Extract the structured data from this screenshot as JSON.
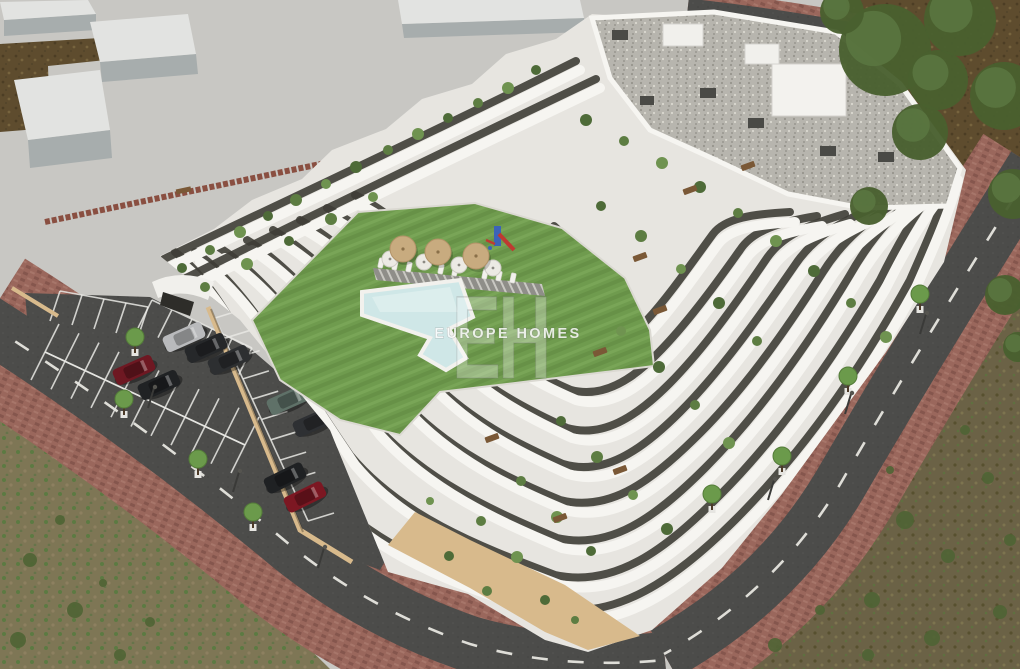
{
  "meta": {
    "image_type": "aerial architectural 3D render",
    "subject": "modern white terraced apartment complex with courtyard lawn, swimming pool, playground, parking lot and surrounding roads"
  },
  "watermark": {
    "monogram": "EH",
    "brand": "EUROPE HOMES"
  },
  "palette": {
    "concrete": "#c8c7c3",
    "building_white": "#e7e5e0",
    "parapet_white": "#f6f5f1",
    "glazing_dark": "#3e3d36",
    "roof_gravel": "#b7b5ae",
    "lawn_green": "#6f9b4e",
    "pool_water": "#cfe7e7",
    "asphalt": "#4c4c4a",
    "sidewalk_brick": "#9a675c",
    "dirt_brown": "#5e4c2e",
    "scrub_field": "#7e7655",
    "base_wall_tan": "#d8ba8c",
    "plant_greens": [
      "#4e6b38",
      "#5d7d42",
      "#6f9350"
    ],
    "playground_blue": "#3c63b8",
    "playground_red": "#bf3a31",
    "parasol_tan": "#c8ab7f",
    "wood_brown": "#7a5836"
  },
  "scene": {
    "massing_blocks": [
      {
        "top": "0,2 88,0 96,14 4,20",
        "side": "4,20 96,14 96,30 4,36"
      },
      {
        "top": "90,22 188,14 196,54 100,62",
        "side": "100,62 196,54 198,74 102,82"
      },
      {
        "top": "14,80 100,70 110,130 28,140",
        "side": "28,140 110,130 112,158 30,168"
      },
      {
        "top": "398,0 580,0 584,18 402,24",
        "side": "402,24 584,18 586,32 404,38"
      }
    ],
    "cars": [
      {
        "x": 184,
        "y": 337,
        "rot": -24,
        "color": "#b9babc",
        "name": "silver-car"
      },
      {
        "x": 206,
        "y": 348,
        "rot": -24,
        "color": "#26282a",
        "name": "black-car"
      },
      {
        "x": 229,
        "y": 360,
        "rot": -24,
        "color": "#2d2f31",
        "name": "dark-gray-car"
      },
      {
        "x": 134,
        "y": 370,
        "rot": -24,
        "color": "#6e1822",
        "name": "dark-red-car"
      },
      {
        "x": 159,
        "y": 385,
        "rot": -24,
        "color": "#202224",
        "name": "black-car"
      },
      {
        "x": 288,
        "y": 400,
        "rot": -24,
        "color": "#5f7168",
        "name": "green-suv"
      },
      {
        "x": 314,
        "y": 422,
        "rot": -24,
        "color": "#2e3033",
        "name": "dark-gray-car"
      },
      {
        "x": 285,
        "y": 478,
        "rot": -26,
        "color": "#1f2123",
        "name": "black-car"
      },
      {
        "x": 305,
        "y": 497,
        "rot": -26,
        "color": "#7c1722",
        "name": "dark-red-car"
      }
    ],
    "parking_rows": [
      {
        "x1": 60,
        "y1": 291,
        "dx": 22,
        "dy": 4,
        "ex": -10,
        "ey": 30,
        "count": 5
      },
      {
        "x1": 152,
        "y1": 300,
        "dx": 20,
        "dy": 9.6,
        "ex": -14,
        "ey": 28,
        "count": 6
      },
      {
        "x1": 45,
        "y1": 352,
        "dx": 20,
        "dy": 9.3,
        "ex": 14,
        "ey": -28,
        "count": 11
      },
      {
        "x1": 45,
        "y1": 352,
        "dx": 20,
        "dy": 9.3,
        "ex": -14,
        "ey": 28,
        "count": 11
      },
      {
        "x1": 215,
        "y1": 318,
        "dx": 9.3,
        "dy": 20.3,
        "ex": 26,
        "ey": -8,
        "count": 11
      }
    ],
    "street_trees": [
      [
        135,
        343
      ],
      [
        124,
        405
      ],
      [
        198,
        465
      ],
      [
        253,
        518
      ],
      [
        920,
        300
      ],
      [
        848,
        382
      ],
      [
        782,
        462
      ],
      [
        712,
        500
      ]
    ],
    "canopy_trees": [
      [
        885,
        50,
        46
      ],
      [
        960,
        20,
        36
      ],
      [
        1004,
        96,
        34
      ],
      [
        920,
        132,
        28
      ],
      [
        1013,
        194,
        25
      ],
      [
        869,
        206,
        19
      ],
      [
        842,
        12,
        22
      ],
      [
        1005,
        295,
        20
      ],
      [
        1018,
        347,
        15
      ],
      [
        938,
        80,
        30
      ]
    ],
    "shrubs": [
      [
        905,
        520,
        9
      ],
      [
        948,
        556,
        7
      ],
      [
        872,
        600,
        8
      ],
      [
        988,
        478,
        6
      ],
      [
        932,
        638,
        8
      ],
      [
        1000,
        612,
        7
      ],
      [
        868,
        655,
        6
      ],
      [
        775,
        645,
        7
      ],
      [
        820,
        610,
        5
      ],
      [
        965,
        430,
        5
      ],
      [
        890,
        470,
        4
      ],
      [
        1010,
        540,
        6
      ],
      [
        30,
        560,
        7
      ],
      [
        75,
        610,
        8
      ],
      [
        120,
        655,
        6
      ],
      [
        18,
        640,
        8
      ],
      [
        60,
        520,
        5
      ],
      [
        150,
        622,
        5
      ],
      [
        103,
        583,
        4
      ]
    ],
    "terrace_plants": [
      [
        182,
        268,
        5
      ],
      [
        210,
        250,
        5
      ],
      [
        240,
        232,
        6
      ],
      [
        268,
        216,
        5
      ],
      [
        296,
        200,
        6
      ],
      [
        326,
        184,
        5
      ],
      [
        356,
        167,
        6
      ],
      [
        388,
        150,
        5
      ],
      [
        418,
        134,
        6
      ],
      [
        448,
        118,
        5
      ],
      [
        478,
        103,
        5
      ],
      [
        508,
        88,
        6
      ],
      [
        536,
        70,
        5
      ],
      [
        205,
        287,
        5
      ],
      [
        247,
        264,
        6
      ],
      [
        289,
        241,
        5
      ],
      [
        331,
        219,
        6
      ],
      [
        373,
        197,
        5
      ],
      [
        586,
        120,
        6
      ],
      [
        624,
        141,
        5
      ],
      [
        662,
        163,
        6
      ],
      [
        700,
        187,
        6
      ],
      [
        738,
        213,
        5
      ],
      [
        776,
        241,
        6
      ],
      [
        814,
        271,
        6
      ],
      [
        851,
        303,
        5
      ],
      [
        886,
        337,
        6
      ],
      [
        601,
        206,
        5
      ],
      [
        641,
        236,
        6
      ],
      [
        681,
        269,
        5
      ],
      [
        719,
        303,
        6
      ],
      [
        757,
        341,
        5
      ],
      [
        621,
        331,
        5
      ],
      [
        659,
        367,
        6
      ],
      [
        695,
        405,
        5
      ],
      [
        729,
        443,
        6
      ],
      [
        561,
        421,
        5
      ],
      [
        597,
        457,
        6
      ],
      [
        633,
        495,
        5
      ],
      [
        667,
        529,
        6
      ],
      [
        521,
        481,
        5
      ],
      [
        557,
        517,
        6
      ],
      [
        591,
        551,
        5
      ],
      [
        481,
        521,
        5
      ],
      [
        517,
        557,
        6
      ],
      [
        449,
        556,
        5
      ],
      [
        487,
        591,
        5
      ],
      [
        430,
        501,
        4
      ],
      [
        545,
        600,
        5
      ],
      [
        575,
        620,
        4
      ]
    ],
    "wood_tables": [
      [
        690,
        190
      ],
      [
        748,
        166
      ],
      [
        640,
        257
      ],
      [
        600,
        352
      ],
      [
        492,
        438
      ],
      [
        560,
        518
      ],
      [
        620,
        470
      ],
      [
        660,
        310
      ]
    ],
    "parasols_round": [
      [
        403,
        249
      ],
      [
        438,
        252
      ],
      [
        476,
        256
      ]
    ],
    "pool_umbrellas": [
      [
        390,
        259
      ],
      [
        424,
        262
      ],
      [
        459,
        265
      ],
      [
        493,
        268
      ]
    ],
    "loungers": [
      [
        381,
        263
      ],
      [
        395,
        265
      ],
      [
        409,
        267
      ],
      [
        441,
        269
      ],
      [
        455,
        271
      ],
      [
        485,
        274
      ],
      [
        499,
        276
      ],
      [
        513,
        278
      ]
    ],
    "lamps": [
      [
        148,
        408
      ],
      [
        233,
        492
      ],
      [
        318,
        568
      ],
      [
        920,
        334
      ],
      [
        845,
        414
      ],
      [
        768,
        500
      ]
    ]
  }
}
